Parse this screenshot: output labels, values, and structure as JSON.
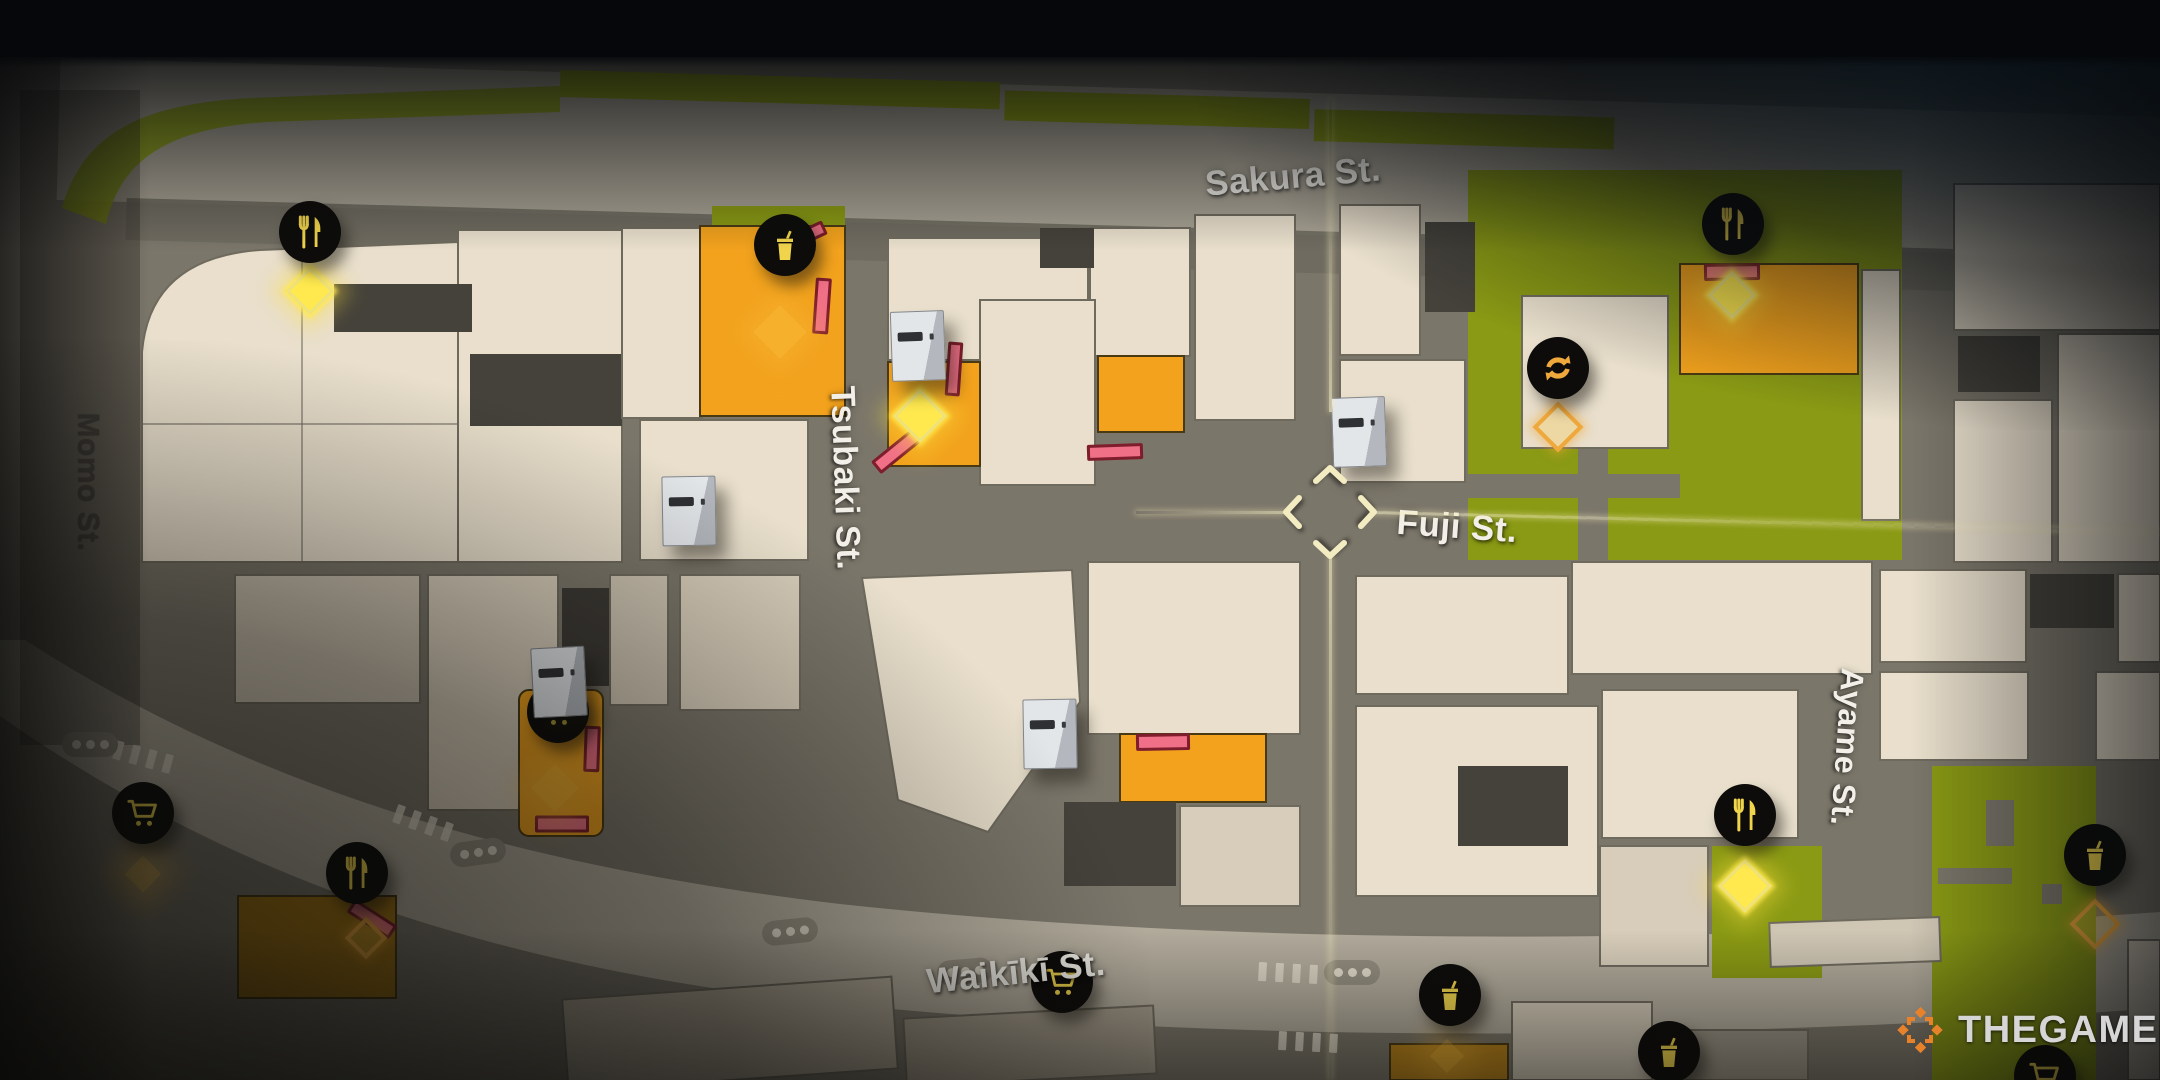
{
  "watermark": {
    "text": "THEGAMER"
  },
  "streets": [
    {
      "id": "sakura",
      "name": "Sakura St.",
      "x": 1293,
      "y": 177,
      "rotation": -5,
      "color": "#f2efe8",
      "size": 35
    },
    {
      "id": "momo",
      "name": "Momo St.",
      "x": 88,
      "y": 482,
      "rotation": 90,
      "color": "#423f38",
      "size": 30
    },
    {
      "id": "tsubaki",
      "name": "Tsubaki St.",
      "x": 845,
      "y": 478,
      "rotation": 88,
      "color": "#f2efe8",
      "size": 34
    },
    {
      "id": "fuji",
      "name": "Fuji St.",
      "x": 1457,
      "y": 527,
      "rotation": 4,
      "color": "#f2efe8",
      "size": 35
    },
    {
      "id": "ayame",
      "name": "Ayame St.",
      "x": 1847,
      "y": 747,
      "rotation": 94,
      "color": "#f2efe8",
      "size": 32
    },
    {
      "id": "waikiki",
      "name": "Waikīkī St.",
      "x": 1016,
      "y": 973,
      "rotation": -6,
      "color": "#f2efe8",
      "size": 35
    }
  ],
  "icons": [
    {
      "type": "restaurant",
      "x": 310,
      "y": 232
    },
    {
      "type": "drink",
      "x": 785,
      "y": 245
    },
    {
      "type": "restaurant",
      "x": 1733,
      "y": 224
    },
    {
      "type": "taxi",
      "x": 1558,
      "y": 368
    },
    {
      "type": "cart",
      "x": 558,
      "y": 712
    },
    {
      "type": "cart",
      "x": 143,
      "y": 813
    },
    {
      "type": "restaurant",
      "x": 357,
      "y": 873
    },
    {
      "type": "restaurant",
      "x": 1745,
      "y": 815
    },
    {
      "type": "drink",
      "x": 2095,
      "y": 855
    },
    {
      "type": "cart",
      "x": 1062,
      "y": 982
    },
    {
      "type": "drink",
      "x": 1450,
      "y": 995
    },
    {
      "type": "drink",
      "x": 1669,
      "y": 1052
    },
    {
      "type": "cart",
      "x": 2045,
      "y": 1076
    }
  ],
  "vending_machines": [
    {
      "x": 917,
      "y": 345,
      "rot": -2
    },
    {
      "x": 688,
      "y": 510,
      "rot": -1
    },
    {
      "x": 558,
      "y": 681,
      "rot": -3
    },
    {
      "x": 1049,
      "y": 733,
      "rot": -1
    },
    {
      "x": 1358,
      "y": 431,
      "rot": -2
    }
  ],
  "markers": [
    {
      "style": "bright",
      "x": 310,
      "y": 291,
      "size": 28
    },
    {
      "style": "soft",
      "x": 780,
      "y": 332,
      "size": 38
    },
    {
      "style": "bright",
      "x": 920,
      "y": 416,
      "size": 32
    },
    {
      "style": "bright",
      "x": 1732,
      "y": 295,
      "size": 28
    },
    {
      "style": "outline",
      "x": 1558,
      "y": 427,
      "size": 28
    },
    {
      "style": "bright",
      "x": 1745,
      "y": 886,
      "size": 32
    },
    {
      "style": "outline",
      "x": 2095,
      "y": 924,
      "size": 28
    },
    {
      "style": "soft",
      "x": 143,
      "y": 874,
      "size": 26
    },
    {
      "style": "outline",
      "x": 366,
      "y": 938,
      "size": 22
    },
    {
      "style": "soft",
      "x": 555,
      "y": 788,
      "size": 34
    },
    {
      "style": "soft",
      "x": 1447,
      "y": 1056,
      "size": 24
    }
  ],
  "entrances": [
    {
      "x": 822,
      "y": 306,
      "w": 10,
      "h": 50,
      "rot": 4
    },
    {
      "x": 812,
      "y": 233,
      "w": 22,
      "h": 9,
      "rot": -25
    },
    {
      "x": 954,
      "y": 369,
      "w": 9,
      "h": 48,
      "rot": 4
    },
    {
      "x": 897,
      "y": 451,
      "w": 48,
      "h": 10,
      "rot": -39
    },
    {
      "x": 1115,
      "y": 452,
      "w": 50,
      "h": 10,
      "rot": -2
    },
    {
      "x": 592,
      "y": 749,
      "w": 10,
      "h": 40,
      "rot": 2
    },
    {
      "x": 562,
      "y": 824,
      "w": 48,
      "h": 11,
      "rot": 0
    },
    {
      "x": 1163,
      "y": 742,
      "w": 48,
      "h": 11,
      "rot": -1
    },
    {
      "x": 1732,
      "y": 272,
      "w": 50,
      "h": 11,
      "rot": -1
    },
    {
      "x": 372,
      "y": 919,
      "w": 44,
      "h": 10,
      "rot": 33
    }
  ],
  "crosswalk_dots": [
    {
      "x": 90,
      "y": 760,
      "rot": 0
    },
    {
      "x": 478,
      "y": 868,
      "rot": -8
    },
    {
      "x": 790,
      "y": 947,
      "rot": -6
    },
    {
      "x": 965,
      "y": 987,
      "rot": -5
    },
    {
      "x": 1352,
      "y": 988,
      "rot": 0
    }
  ],
  "crosswalk_stripes": [
    {
      "x": 143,
      "y": 757,
      "rot": 15
    },
    {
      "x": 423,
      "y": 823,
      "rot": 20
    },
    {
      "x": 1288,
      "y": 973,
      "rot": 3
    },
    {
      "x": 1308,
      "y": 1042,
      "rot": 3
    }
  ],
  "crosshair": {
    "x": 1330,
    "y": 512
  },
  "colors": {
    "map_background": "#7b766a",
    "building": "#e9dfcc",
    "building_dark": "#45423b",
    "green": "#8a9a14",
    "highlight_orange": "#f2a21d",
    "entrance_pink": "#f07087",
    "entrance_border": "#7e1d2c",
    "icon_background": "#0d0c0a",
    "icon_gold": "#f0d44c",
    "marker_yellow": "#ffe94f",
    "marker_orange": "#efa83c",
    "cursor": "#f3ecc2",
    "label_white": "#f2efe8",
    "label_dark": "#423f38",
    "watermark_orange": "#e8822a",
    "watermark_text": "#d6d6d6"
  }
}
